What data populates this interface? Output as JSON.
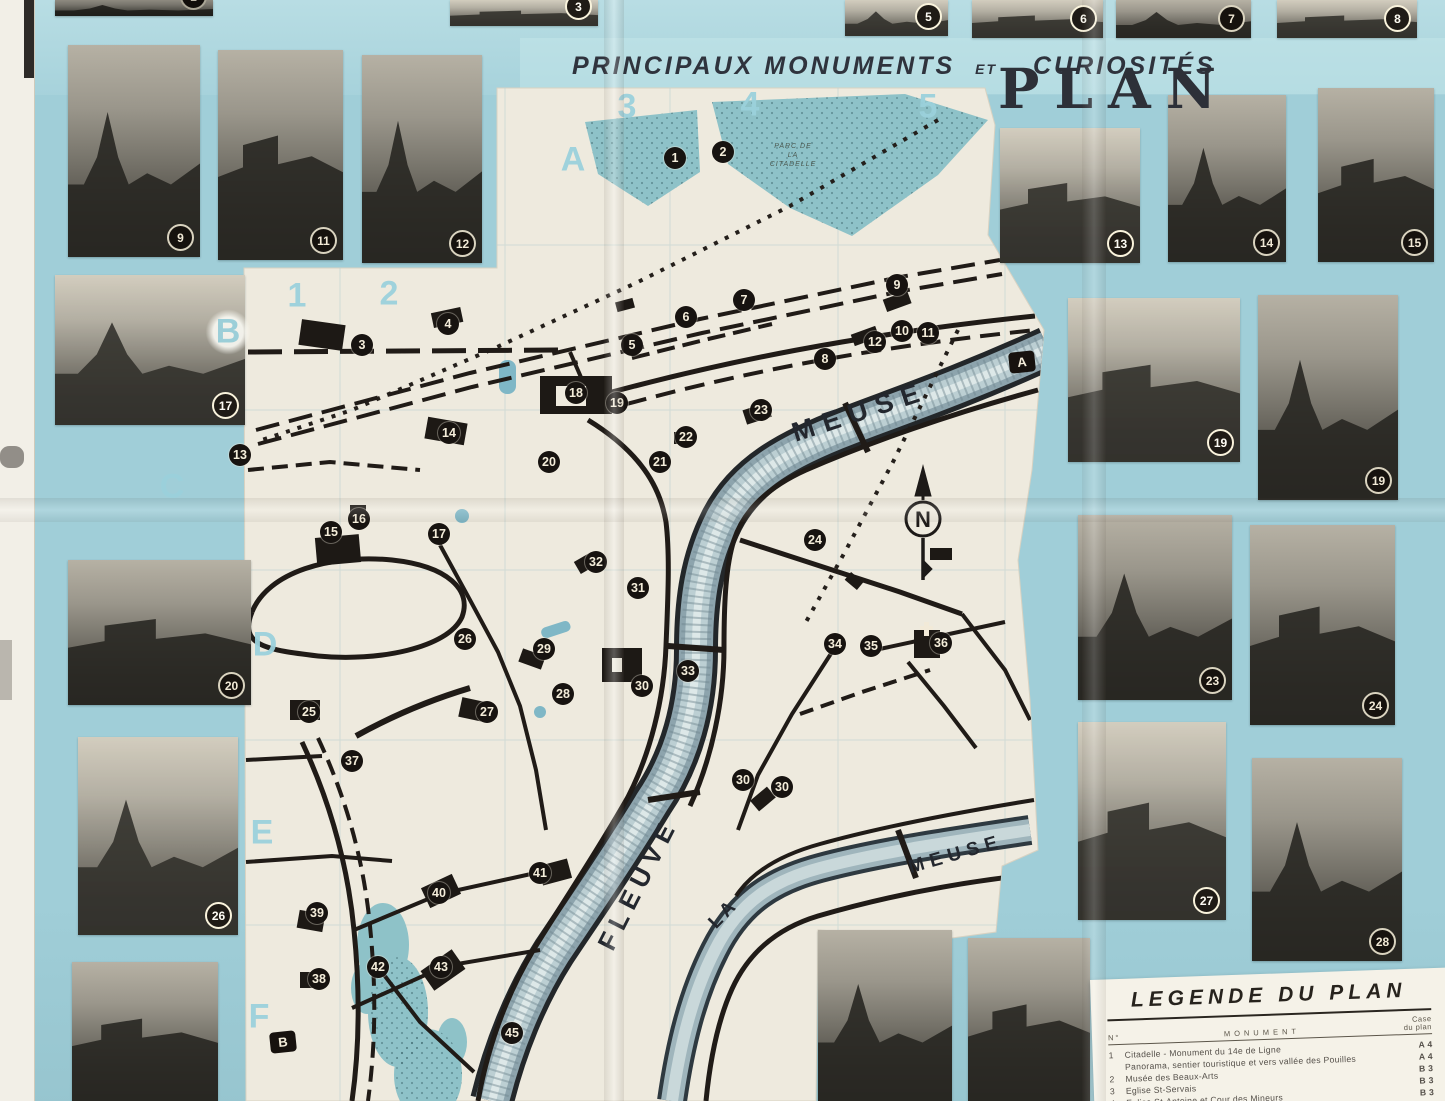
{
  "header": {
    "title_main": "PRINCIPAUX MONUMENTS",
    "title_et": "ET",
    "title_tail": "CURIOSITÉS",
    "plan": "PLAN"
  },
  "map": {
    "compass_letter": "N",
    "park_label": [
      "PARC DE",
      "LA",
      "CITADELLE"
    ],
    "river_labels": [
      {
        "text": "MEUSE",
        "x": 860,
        "y": 412,
        "rot": -18,
        "size": 27,
        "ls": 9
      },
      {
        "text": "FLEUVE",
        "x": 638,
        "y": 884,
        "rot": -63,
        "size": 26,
        "ls": 7
      },
      {
        "text": "LA",
        "x": 724,
        "y": 914,
        "rot": -46,
        "size": 19,
        "ls": 4
      },
      {
        "text": "MEUSE",
        "x": 956,
        "y": 855,
        "rot": -16,
        "size": 19,
        "ls": 6
      }
    ],
    "grid_labels": [
      {
        "text": "1",
        "x": 297,
        "y": 296
      },
      {
        "text": "2",
        "x": 389,
        "y": 294
      },
      {
        "text": "3",
        "x": 627,
        "y": 107
      },
      {
        "text": "4",
        "x": 750,
        "y": 105
      },
      {
        "text": "5",
        "x": 928,
        "y": 107
      },
      {
        "text": "A",
        "x": 573,
        "y": 160
      },
      {
        "text": "B",
        "x": 228,
        "y": 332,
        "halo": true
      },
      {
        "text": "C",
        "x": 172,
        "y": 487
      },
      {
        "text": "D",
        "x": 265,
        "y": 645
      },
      {
        "text": "E",
        "x": 262,
        "y": 833
      },
      {
        "text": "F",
        "x": 259,
        "y": 1017
      }
    ],
    "edge_markers": [
      {
        "text": "A",
        "x": 1022,
        "y": 362
      },
      {
        "text": "B",
        "x": 283,
        "y": 1042
      }
    ],
    "badges": [
      {
        "n": "1",
        "x": 675,
        "y": 158
      },
      {
        "n": "2",
        "x": 723,
        "y": 152
      },
      {
        "n": "3",
        "x": 362,
        "y": 345
      },
      {
        "n": "4",
        "x": 448,
        "y": 324
      },
      {
        "n": "5",
        "x": 632,
        "y": 345
      },
      {
        "n": "6",
        "x": 686,
        "y": 317
      },
      {
        "n": "7",
        "x": 744,
        "y": 300
      },
      {
        "n": "8",
        "x": 825,
        "y": 359
      },
      {
        "n": "9",
        "x": 897,
        "y": 285
      },
      {
        "n": "10",
        "x": 902,
        "y": 331
      },
      {
        "n": "11",
        "x": 928,
        "y": 333
      },
      {
        "n": "12",
        "x": 875,
        "y": 342
      },
      {
        "n": "13",
        "x": 240,
        "y": 455
      },
      {
        "n": "14",
        "x": 449,
        "y": 433
      },
      {
        "n": "15",
        "x": 331,
        "y": 532
      },
      {
        "n": "16",
        "x": 359,
        "y": 519
      },
      {
        "n": "17",
        "x": 439,
        "y": 534
      },
      {
        "n": "18",
        "x": 576,
        "y": 393
      },
      {
        "n": "19",
        "x": 617,
        "y": 403
      },
      {
        "n": "20",
        "x": 549,
        "y": 462
      },
      {
        "n": "21",
        "x": 660,
        "y": 462
      },
      {
        "n": "22",
        "x": 686,
        "y": 437
      },
      {
        "n": "23",
        "x": 761,
        "y": 410
      },
      {
        "n": "24",
        "x": 815,
        "y": 540
      },
      {
        "n": "25",
        "x": 309,
        "y": 712
      },
      {
        "n": "26",
        "x": 465,
        "y": 639
      },
      {
        "n": "27",
        "x": 487,
        "y": 712
      },
      {
        "n": "28",
        "x": 563,
        "y": 694
      },
      {
        "n": "29",
        "x": 544,
        "y": 649
      },
      {
        "n": "30",
        "x": 642,
        "y": 686
      },
      {
        "n": "30",
        "x": 743,
        "y": 780
      },
      {
        "n": "30",
        "x": 782,
        "y": 787
      },
      {
        "n": "31",
        "x": 638,
        "y": 588
      },
      {
        "n": "32",
        "x": 596,
        "y": 562
      },
      {
        "n": "33",
        "x": 688,
        "y": 671
      },
      {
        "n": "34",
        "x": 835,
        "y": 644
      },
      {
        "n": "35",
        "x": 871,
        "y": 646
      },
      {
        "n": "36",
        "x": 941,
        "y": 643
      },
      {
        "n": "37",
        "x": 352,
        "y": 761
      },
      {
        "n": "38",
        "x": 319,
        "y": 979
      },
      {
        "n": "39",
        "x": 317,
        "y": 913
      },
      {
        "n": "40",
        "x": 439,
        "y": 893
      },
      {
        "n": "41",
        "x": 540,
        "y": 873
      },
      {
        "n": "42",
        "x": 378,
        "y": 967
      },
      {
        "n": "43",
        "x": 441,
        "y": 967
      },
      {
        "n": "45",
        "x": 512,
        "y": 1033
      }
    ]
  },
  "photos": [
    {
      "badge": "1",
      "x": 55,
      "y": 0,
      "w": 158,
      "h": 16,
      "tone": "t3"
    },
    {
      "badge": "3",
      "x": 450,
      "y": 0,
      "w": 148,
      "h": 26,
      "tone": "t2"
    },
    {
      "badge": "5",
      "x": 845,
      "y": 0,
      "w": 103,
      "h": 36,
      "tone": "t2"
    },
    {
      "badge": "6",
      "x": 972,
      "y": 0,
      "w": 131,
      "h": 38,
      "tone": "t2"
    },
    {
      "badge": "7",
      "x": 1116,
      "y": 0,
      "w": 135,
      "h": 38,
      "tone": "t1"
    },
    {
      "badge": "8",
      "x": 1277,
      "y": 0,
      "w": 140,
      "h": 38,
      "tone": "t2"
    },
    {
      "badge": "9",
      "x": 68,
      "y": 45,
      "w": 132,
      "h": 212,
      "tone": "t1"
    },
    {
      "badge": "11",
      "x": 218,
      "y": 50,
      "w": 125,
      "h": 210,
      "tone": "t1"
    },
    {
      "badge": "12",
      "x": 362,
      "y": 55,
      "w": 120,
      "h": 208,
      "tone": "t1"
    },
    {
      "badge": "13",
      "x": 1000,
      "y": 128,
      "w": 140,
      "h": 135,
      "tone": "t2"
    },
    {
      "badge": "14",
      "x": 1168,
      "y": 95,
      "w": 118,
      "h": 167,
      "tone": "t1"
    },
    {
      "badge": "15",
      "x": 1318,
      "y": 88,
      "w": 116,
      "h": 174,
      "tone": "t1"
    },
    {
      "badge": "17",
      "x": 55,
      "y": 275,
      "w": 190,
      "h": 150,
      "tone": "t2"
    },
    {
      "badge": "19",
      "x": 1068,
      "y": 298,
      "w": 172,
      "h": 164,
      "tone": "t2"
    },
    {
      "badge": "19",
      "x": 1258,
      "y": 295,
      "w": 140,
      "h": 205,
      "tone": "t1"
    },
    {
      "badge": "20",
      "x": 68,
      "y": 560,
      "w": 183,
      "h": 145,
      "tone": "t1"
    },
    {
      "badge": "23",
      "x": 1078,
      "y": 515,
      "w": 154,
      "h": 185,
      "tone": "t1"
    },
    {
      "badge": "24",
      "x": 1250,
      "y": 525,
      "w": 145,
      "h": 200,
      "tone": "t1"
    },
    {
      "badge": "26",
      "x": 78,
      "y": 737,
      "w": 160,
      "h": 198,
      "tone": "t2"
    },
    {
      "badge": "27",
      "x": 1078,
      "y": 722,
      "w": 148,
      "h": 198,
      "tone": "t2"
    },
    {
      "badge": "28",
      "x": 1252,
      "y": 758,
      "w": 150,
      "h": 203,
      "tone": "t1"
    },
    {
      "badge": null,
      "x": 72,
      "y": 962,
      "w": 146,
      "h": 139,
      "tone": "t1"
    },
    {
      "badge": null,
      "x": 818,
      "y": 930,
      "w": 134,
      "h": 171,
      "tone": "t1"
    },
    {
      "badge": null,
      "x": 968,
      "y": 938,
      "w": 122,
      "h": 163,
      "tone": "t1"
    }
  ],
  "legend": {
    "title": "LEGENDE DU PLAN",
    "col_no": "N°",
    "col_monument": "MONUMENT",
    "col_case_1": "Case",
    "col_case_2": "du plan",
    "rows": [
      {
        "no": "1",
        "name": "Citadelle - Monument du 14e de Ligne",
        "case": "A 4"
      },
      {
        "no": "",
        "name": "Panorama, sentier touristique et vers vallée des Pouilles",
        "case": "A 4"
      },
      {
        "no": "2",
        "name": "Musée des Beaux-Arts",
        "case": "B 3"
      },
      {
        "no": "3",
        "name": "Eglise St-Servais",
        "case": "B 3"
      },
      {
        "no": "4",
        "name": "Eglise St-Antoine et Cour des Mineurs",
        "case": "B 3"
      }
    ]
  }
}
